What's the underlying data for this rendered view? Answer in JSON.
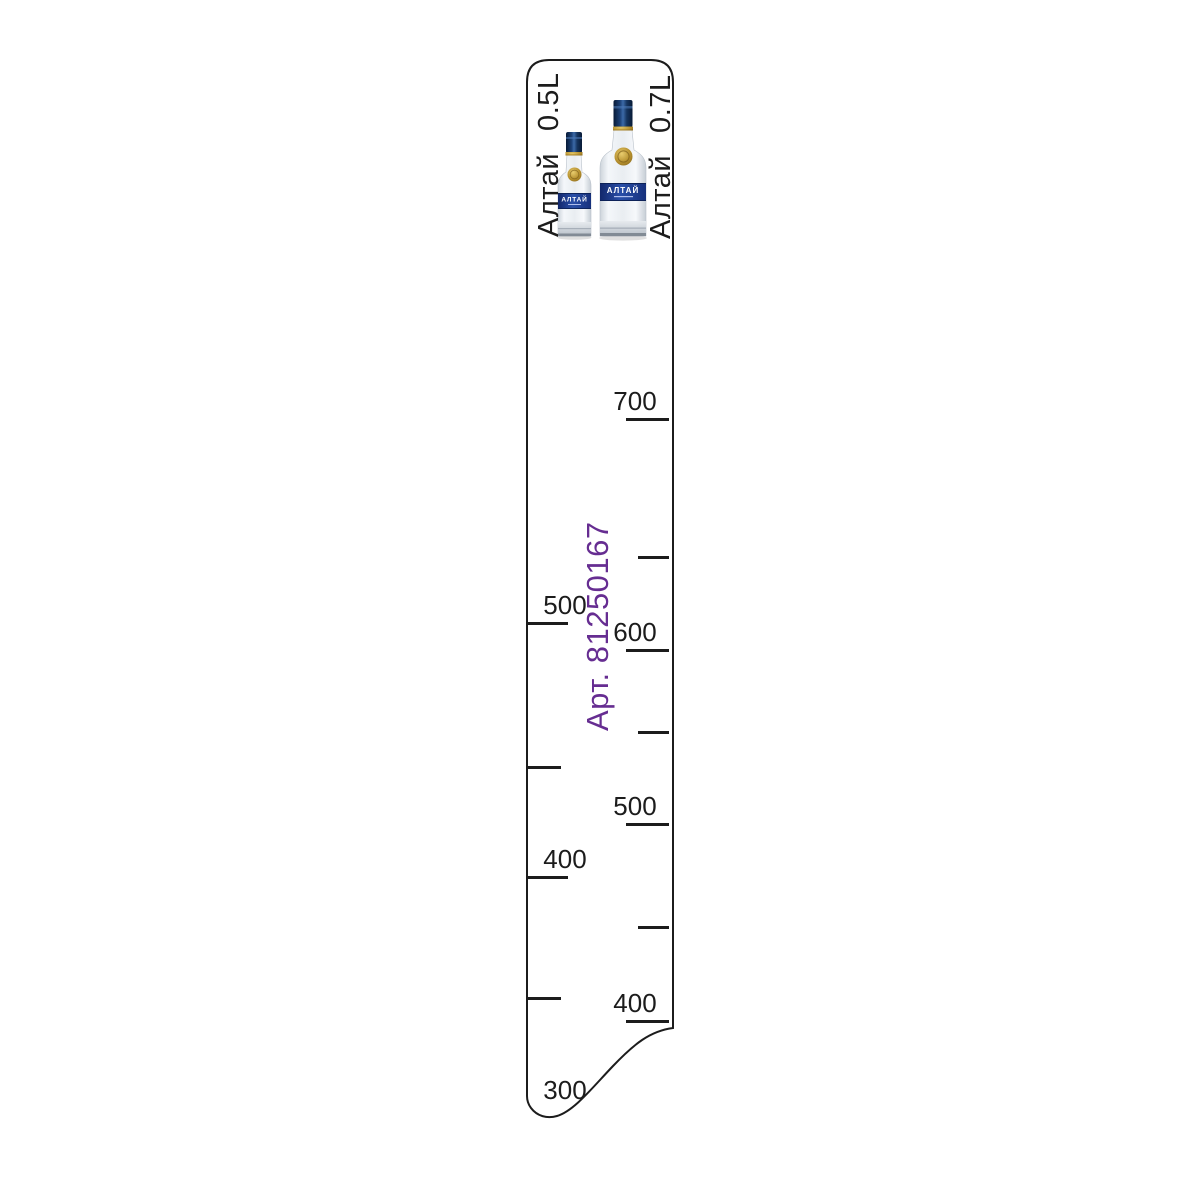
{
  "ruler": {
    "article": "Арт. 81250167",
    "left_header": {
      "brand": "Алтай",
      "volume": "0.5L"
    },
    "right_header": {
      "brand": "Алтай",
      "volume": "0.7L"
    },
    "bottles": [
      {
        "name": "altai-0.5l",
        "label": "АЛТАЙ",
        "volume": "0.5L"
      },
      {
        "name": "altai-0.7l",
        "label": "АЛТАЙ",
        "volume": "0.7L"
      }
    ],
    "scale": {
      "left": [
        {
          "y": 623,
          "label": "500"
        },
        {
          "y": 767,
          "label": ""
        },
        {
          "y": 877,
          "label": "400"
        },
        {
          "y": 998,
          "label": ""
        },
        {
          "y": 1108,
          "label": "300",
          "line": false
        }
      ],
      "right": [
        {
          "y": 419,
          "label": "700"
        },
        {
          "y": 557,
          "label": ""
        },
        {
          "y": 650,
          "label": "600"
        },
        {
          "y": 732,
          "label": ""
        },
        {
          "y": 824,
          "label": "500"
        },
        {
          "y": 927,
          "label": ""
        },
        {
          "y": 1021,
          "label": "400"
        }
      ]
    },
    "colors": {
      "line": "#1c1c1c",
      "article_purple": "#662d91",
      "cap_navy": "#16355f",
      "label_blue": "#24459c",
      "gold": "#c9a13b",
      "glass": "#e9edf1"
    }
  }
}
